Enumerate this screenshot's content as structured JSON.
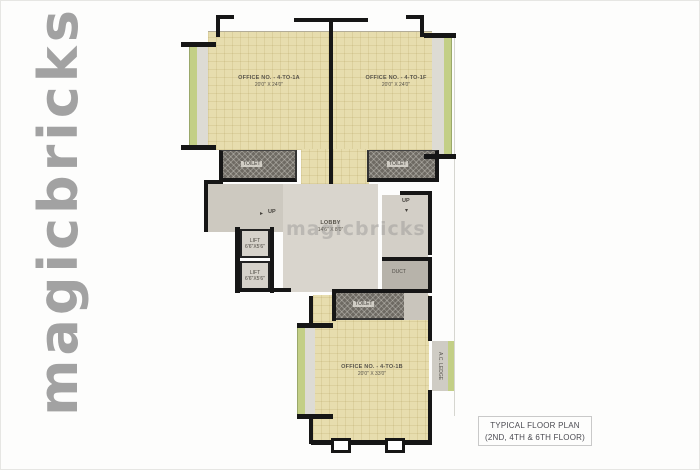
{
  "watermark": {
    "side": "magicbricks",
    "center": "magicbricks"
  },
  "title_box": {
    "line1": "TYPICAL FLOOR PLAN",
    "line2": "(2ND, 4TH & 6TH FLOOR)"
  },
  "rooms": {
    "office_top_left": {
      "label": "OFFICE NO. - 4-TO-1A",
      "dims": "20'0\" X 24'0\""
    },
    "office_top_right": {
      "label": "OFFICE NO. - 4-TO-1F",
      "dims": "20'0\" X 24'0\""
    },
    "office_bottom": {
      "label": "OFFICE NO. - 4-TO-1B",
      "dims": "20'0\" X 33'0\""
    },
    "lobby": {
      "label": "LOBBY",
      "dims": "14'6\" X 8'0\""
    },
    "lift_top": {
      "label": "LIFT",
      "dims": "6'6\"X5'6\""
    },
    "lift_bottom": {
      "label": "LIFT",
      "dims": "6'6\"X5'6\""
    },
    "toilet_left": {
      "label": "TOILET"
    },
    "toilet_right": {
      "label": "TOILET"
    },
    "toilet_bottom": {
      "label": "TOILET"
    },
    "duct": {
      "label": "DUCT"
    },
    "ac_ledge": {
      "label": "A.C. LEDGE"
    },
    "stairs": {
      "label": "UP",
      "arrow": "▾"
    },
    "entry": {
      "label": "UP",
      "arrow": "▸"
    }
  },
  "colors": {
    "room_fill": "#e7ddae",
    "room_grid": "#d9cd9a",
    "balcony_green": "#c3cf86",
    "ledge_gray": "#dddbd4",
    "lobby_gray": "#d9d5cd",
    "passage_gray": "#cdc9c0",
    "duct_gray": "#b7b3aa",
    "hatch_dark": "#6e6a63",
    "wall_black": "#161616",
    "watermark_gray": "#a2a2a2",
    "title_text": "#4b4b52"
  }
}
